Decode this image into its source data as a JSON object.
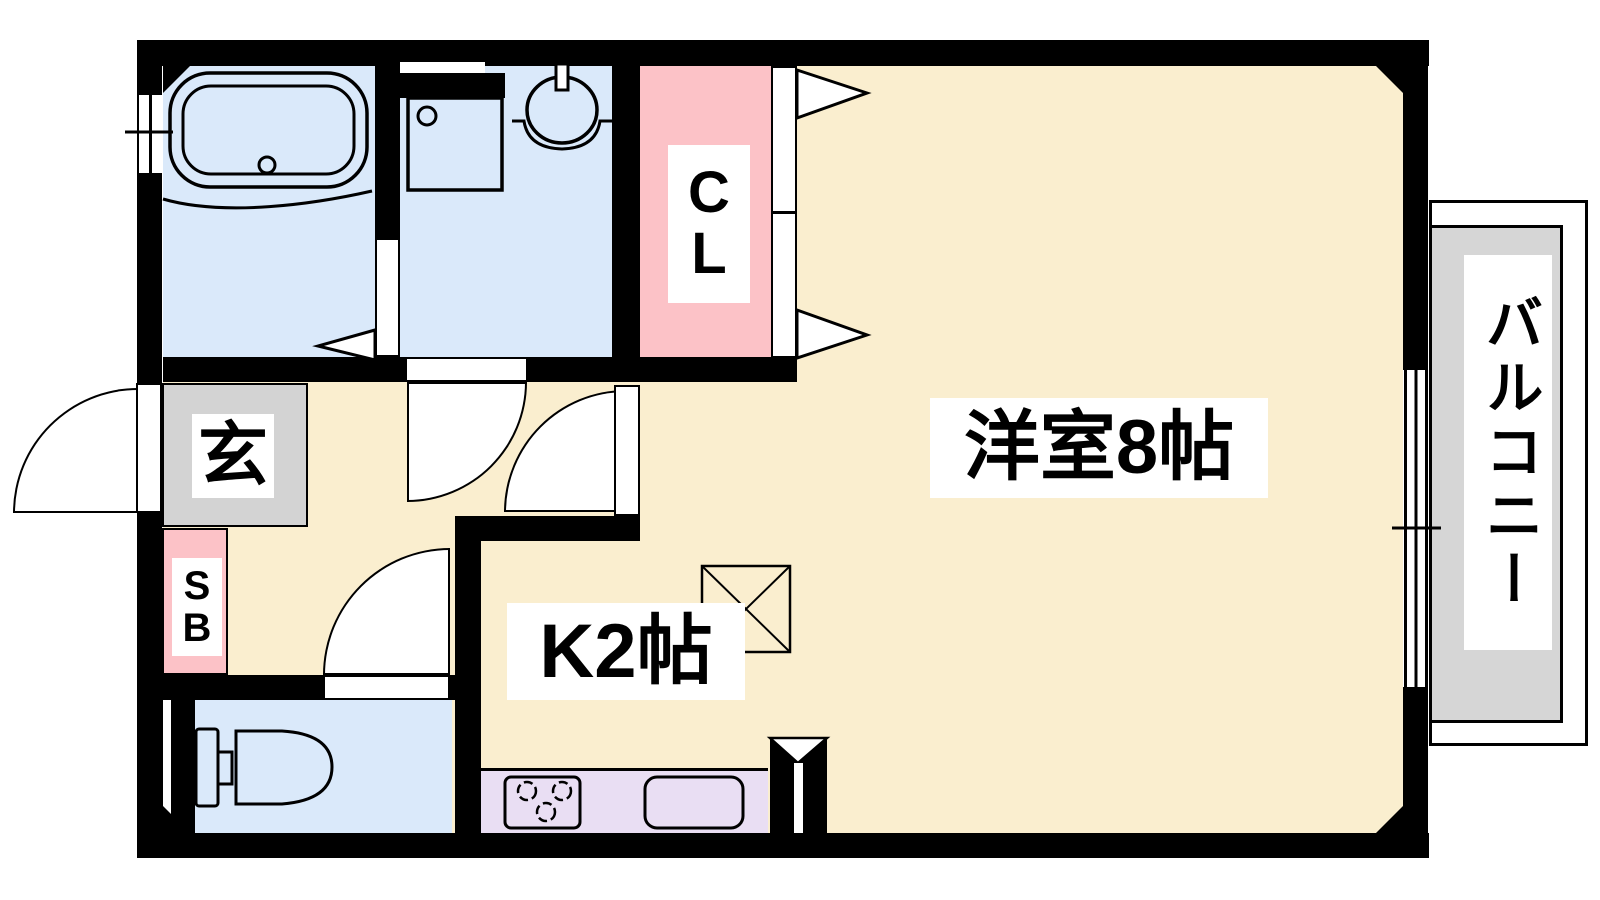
{
  "floorplan": {
    "type": "japanese-apartment-floor-plan",
    "rooms": {
      "western_room": {
        "label": "洋室8帖"
      },
      "kitchen": {
        "label": "K2帖"
      },
      "closet": {
        "line1": "C",
        "line2": "L"
      },
      "entrance": {
        "label": "玄"
      },
      "shoe_box": {
        "line1": "S",
        "line2": "B"
      },
      "balcony": {
        "label": "バルコニー"
      }
    },
    "fixtures": [
      "bathtub",
      "washing-machine-pan",
      "washbasin",
      "toilet",
      "gas-stove",
      "kitchen-sink",
      "refrigerator-space",
      "sliding-window"
    ],
    "colors": {
      "room_floor": "#FAEECF",
      "wet_area_blue": "#DAE9FA",
      "closet_pink": "#FCC2C7",
      "entrance_gray": "#D3D3D3",
      "balcony_gray": "#D6D6D6",
      "kitchen_counter_purple": "#E9DEF3",
      "wall": "#000000"
    }
  }
}
